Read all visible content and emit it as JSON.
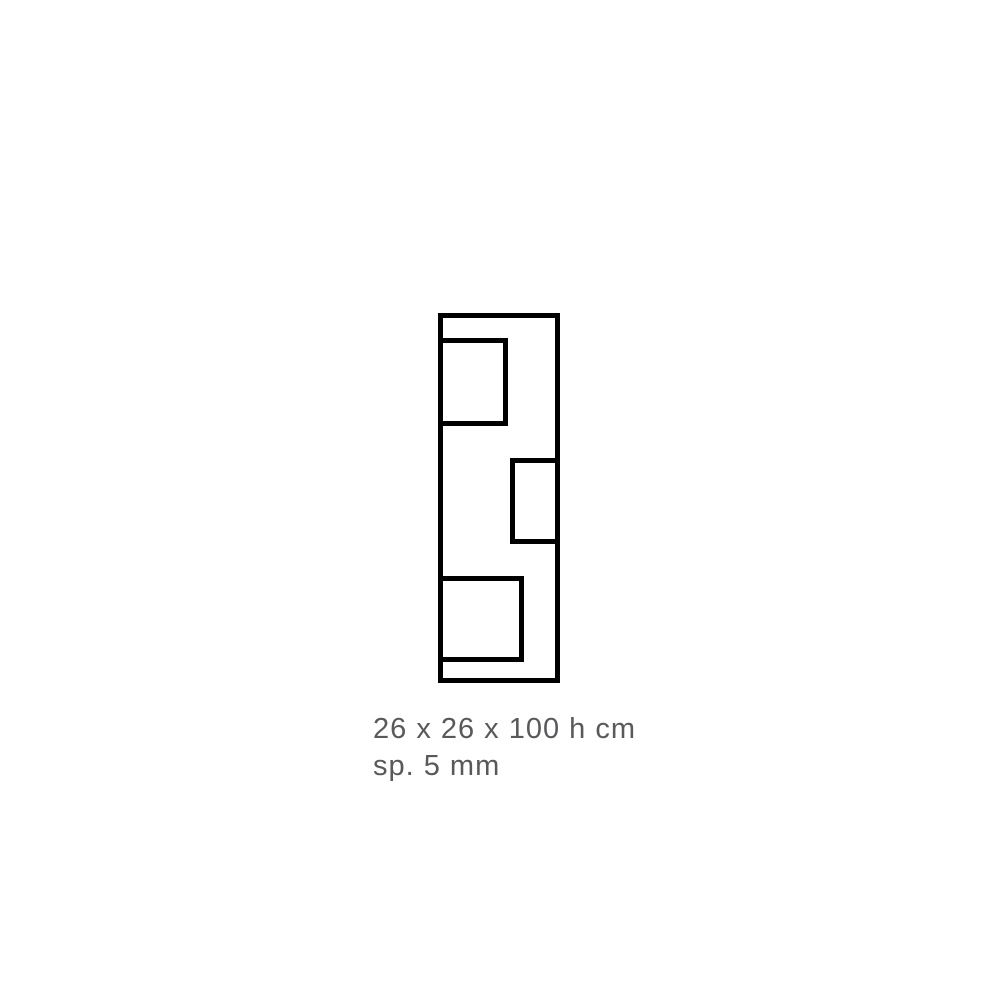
{
  "page": {
    "background_color": "#ffffff"
  },
  "diagram": {
    "type": "product-outline-drawing",
    "subject": "vase-front-elevation",
    "stroke_color": "#000000",
    "shapes": [
      "outer-frame",
      "window-top-left",
      "window-middle-right",
      "window-bottom-left"
    ]
  },
  "caption": {
    "dimensions": "26 x 26 x 100 h cm",
    "thickness": "sp. 5 mm",
    "text_color": "#58595b"
  }
}
